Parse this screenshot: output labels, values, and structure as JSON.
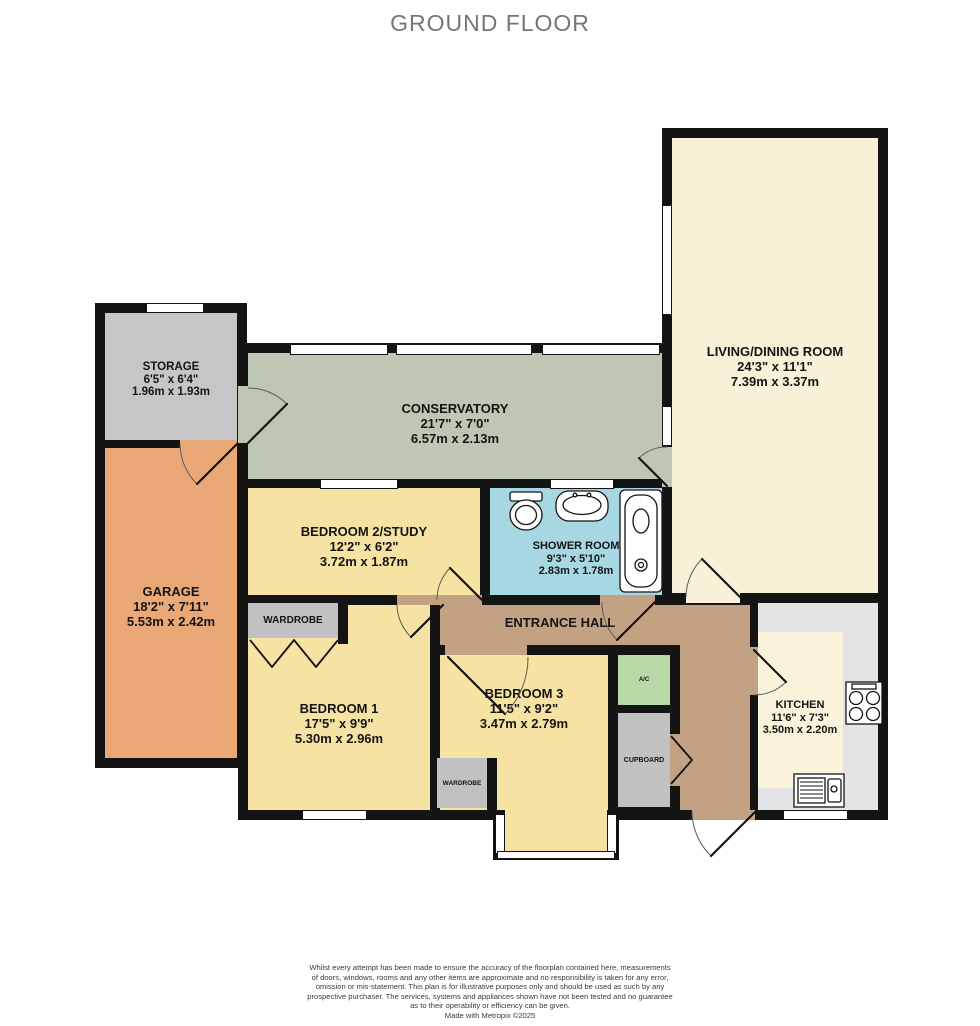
{
  "title": "GROUND FLOOR",
  "rooms": {
    "storage": {
      "name": "STORAGE",
      "imperial": "6'5\"  x 6'4\"",
      "metric": "1.96m  x 1.93m"
    },
    "garage": {
      "name": "GARAGE",
      "imperial": "18'2\"  x 7'11\"",
      "metric": "5.53m  x 2.42m"
    },
    "conservatory": {
      "name": "CONSERVATORY",
      "imperial": "21'7\"  x 7'0\"",
      "metric": "6.57m  x 2.13m"
    },
    "living_dining": {
      "name": "LIVING/DINING ROOM",
      "imperial": "24'3\"  x 11'1\"",
      "metric": "7.39m  x 3.37m"
    },
    "bedroom2": {
      "name": "BEDROOM 2/STUDY",
      "imperial": "12'2\"  x 6'2\"",
      "metric": "3.72m  x 1.87m"
    },
    "shower_room": {
      "name": "SHOWER ROOM",
      "imperial": "9'3\"  x 5'10\"",
      "metric": "2.83m  x 1.78m"
    },
    "entrance_hall": {
      "name": "ENTRANCE HALL"
    },
    "bedroom1": {
      "name": "BEDROOM 1",
      "imperial": "17'5\"  x 9'9\"",
      "metric": "5.30m  x 2.96m"
    },
    "bedroom3": {
      "name": "BEDROOM 3",
      "imperial": "11'5\"  x 9'2\"",
      "metric": "3.47m  x 2.79m"
    },
    "kitchen": {
      "name": "KITCHEN",
      "imperial": "11'6\"  x 7'3\"",
      "metric": "3.50m  x 2.20m"
    }
  },
  "features": {
    "wardrobe_bedroom1": "WARDROBE",
    "wardrobe_bedroom3": "WARDROBE",
    "cupboard": "CUPBOARD",
    "airing_cupboard": "A/C"
  },
  "fixtures": [
    "toilet",
    "basin",
    "bath",
    "hob",
    "kitchen-sink"
  ],
  "colors": {
    "wall": "#141414",
    "storage": "#c6c5c7",
    "garage": "#e9a876",
    "conservatory": "#bec7b4",
    "living_dining": "#f8f1d8",
    "bedrooms": "#f6e3a3",
    "shower_room": "#a6d7e3",
    "entrance_hall": "#c3a284",
    "airing_cupboard": "#b8d8a8",
    "cupboard_wardrobe": "#c1c0c2",
    "kitchen_counter": "#e4e4e6",
    "kitchen_floor": "#faf3dc",
    "title_text": "#76767a"
  },
  "footer": {
    "lines": [
      "Whilst every attempt has been made to ensure the accuracy of the floorplan contained here, measurements",
      "of doors, windows, rooms and any other items are approximate and no responsibility is taken for any error,",
      "omission or mis-statement. This plan is for illustrative purposes only and should be used as such by any",
      "prospective purchaser. The services, systems and appliances shown have not been tested and no guarantee",
      "as to their operability or efficiency can be given.",
      "Made with Metropix ©2025"
    ]
  }
}
